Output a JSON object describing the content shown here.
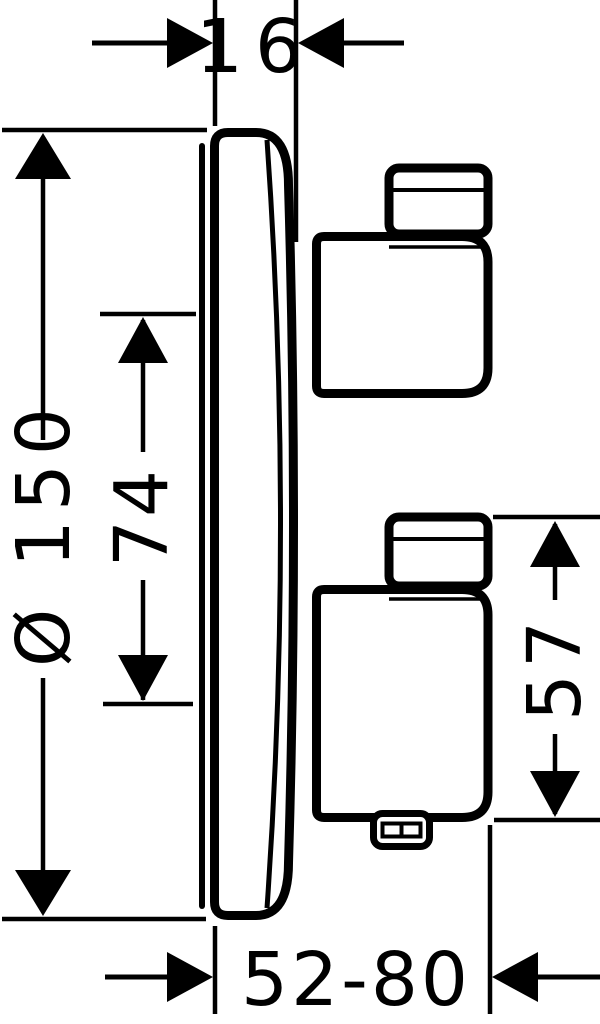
{
  "drawing": {
    "colors": {
      "line": "#000000",
      "background": "#ffffff"
    },
    "dimensions": {
      "depth": {
        "label": "16"
      },
      "diameter": {
        "label": "Ø 150"
      },
      "axis_spacing": {
        "label": "74"
      },
      "handle_height": {
        "label": "57"
      },
      "depth_range": {
        "label": "52-80"
      }
    }
  }
}
